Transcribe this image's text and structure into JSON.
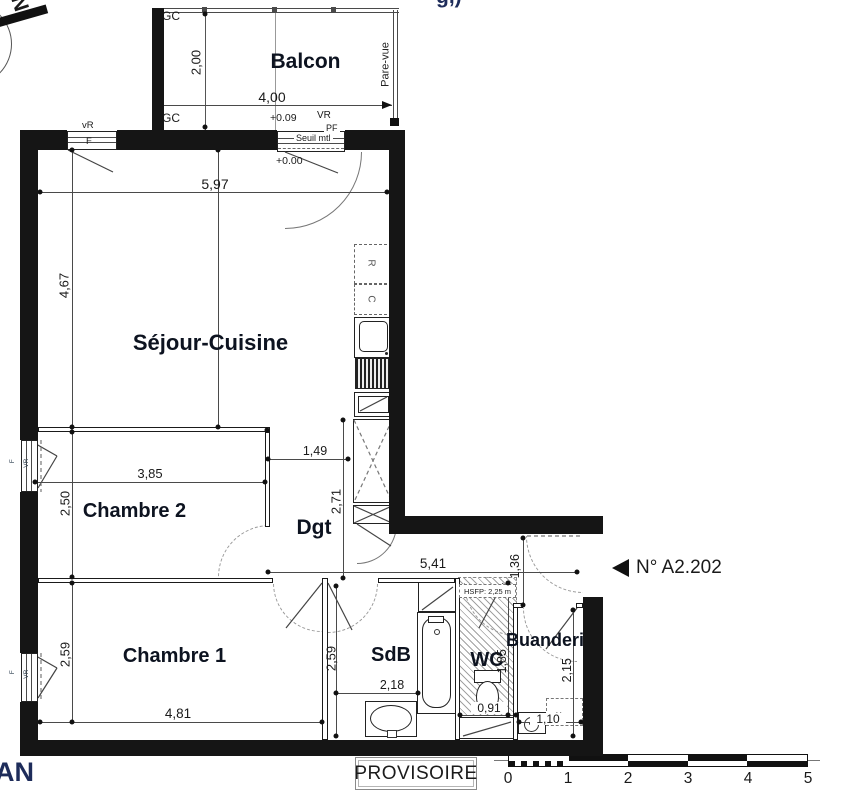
{
  "north": {
    "label": "N"
  },
  "fragments": {
    "top": "g,)",
    "bottom_left": "AN"
  },
  "balcony": {
    "label": "Balcon",
    "gc_top": "GC",
    "gc_bottom": "GC",
    "pare_vue": "Pare-vue",
    "dim_width": "4,00",
    "dim_depth": "2,00"
  },
  "top_openings": {
    "window": {
      "shutter": "vR",
      "leaf": "F"
    },
    "door": {
      "level_out": "+0.09",
      "shutter": "VR",
      "type": "PF",
      "threshold": "Seuil mtl",
      "level_in": "+0.00"
    }
  },
  "rooms": {
    "sejour": {
      "label": "Séjour-Cuisine",
      "dim_width": "5,97",
      "dim_height": "4,67"
    },
    "chambre2": {
      "label": "Chambre 2",
      "dim_width": "3,85",
      "dim_height": "2,50",
      "window": {
        "leaf": "F",
        "shutter": "VR"
      }
    },
    "dgt": {
      "label": "Dgt",
      "dim_width": "1,49",
      "dim_height": "2,71"
    },
    "chambre1": {
      "label": "Chambre 1",
      "dim_width": "4,81",
      "dim_height": "2,59",
      "window": {
        "leaf": "F",
        "shutter": "VR"
      }
    },
    "sdb": {
      "label": "SdB",
      "dim_width": "2,18",
      "dim_height": "2,59"
    },
    "wc": {
      "label": "WC",
      "dim_width": "0,91",
      "dim_height": "1,85",
      "soffit": "HSFP: 2,25 m"
    },
    "buanderie": {
      "label": "Buanderie",
      "dim_width": "1,10",
      "dim_height": "2,15",
      "machine": "LL"
    }
  },
  "kitchen": {
    "fridge": "R",
    "cooker": "C"
  },
  "entry": {
    "unit_marker": "N° A2.202",
    "dim_corridor": "5,41",
    "dim_entry": "1,36"
  },
  "footer": {
    "status": "PROVISOIRE",
    "scale": [
      "0",
      "1",
      "2",
      "3",
      "4",
      "5"
    ]
  }
}
